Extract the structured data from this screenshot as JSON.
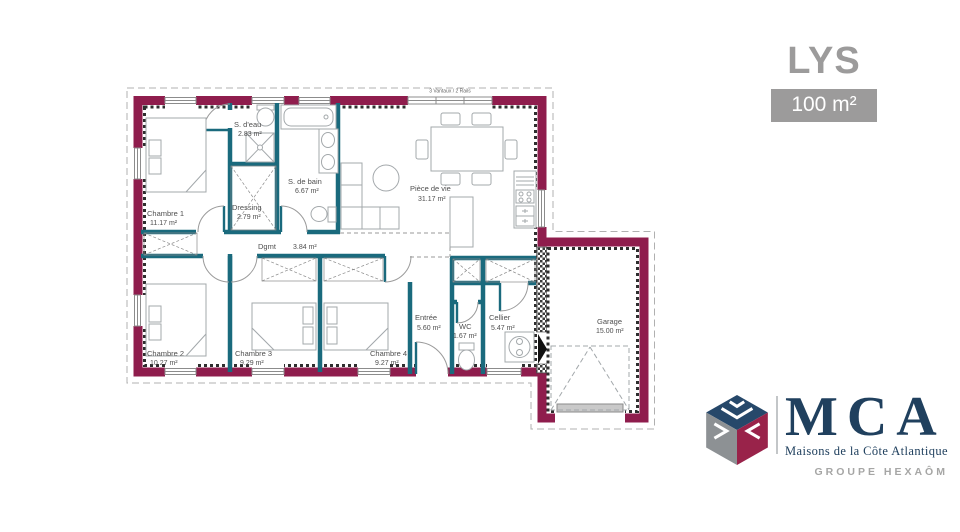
{
  "header": {
    "model_name": "LYS",
    "area_label": "100 m²"
  },
  "plan": {
    "window_annotation": "3 Vantaux / 2 Rails",
    "rooms": [
      {
        "name": "Chambre 1",
        "area": "11.17 m²"
      },
      {
        "name": "S. d'eau",
        "area": "2.83 m²"
      },
      {
        "name": "S. de bain",
        "area": "6.67 m²"
      },
      {
        "name": "Dressing",
        "area": "2.79 m²"
      },
      {
        "name": "Pièce de vie",
        "area": "31.17 m²"
      },
      {
        "name": "Dgmt",
        "area": "3.84 m²"
      },
      {
        "name": "Chambre 2",
        "area": "10.27 m²"
      },
      {
        "name": "Chambre 3",
        "area": "9.29 m²"
      },
      {
        "name": "Chambre 4",
        "area": "9.27 m²"
      },
      {
        "name": "Entrée",
        "area": "5.60 m²"
      },
      {
        "name": "WC",
        "area": "1.67 m²"
      },
      {
        "name": "Cellier",
        "area": "5.47 m²"
      },
      {
        "name": "Garage",
        "area": "15.00 m²"
      }
    ],
    "colors": {
      "exterior_wall": "#8f1d4d",
      "interior_wall": "#1a6a7d",
      "furniture_outline": "#a3a8ab"
    }
  },
  "branding": {
    "name": "MCA",
    "subtitle": "Maisons de la Côte Atlantique",
    "group": "GROUPE HEXAÔM",
    "colors": {
      "navy": "#20405e",
      "maroon": "#99234a",
      "gray": "#8d9194"
    }
  }
}
